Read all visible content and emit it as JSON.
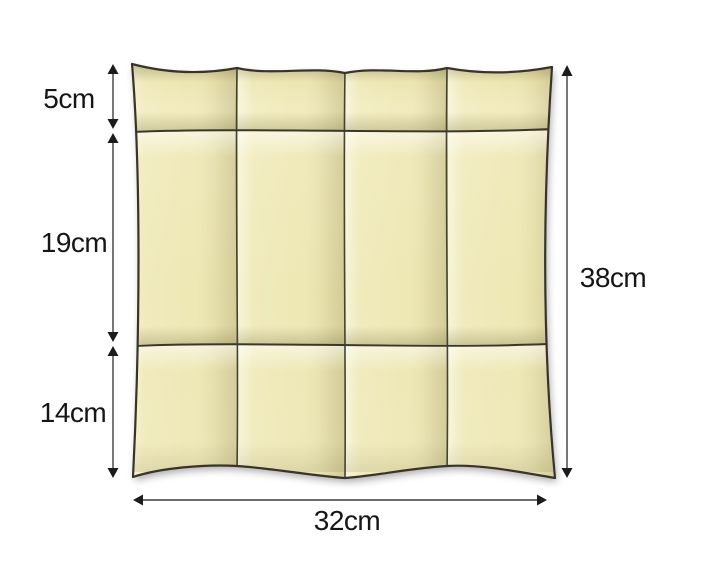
{
  "figure": {
    "subject": "folded-cloth-dimension-diagram",
    "background_color": "#ffffff",
    "cloth": {
      "base_color": "#ece6b0",
      "highlight_color": "#f7f2d0",
      "shadow_color": "#dcd39b",
      "outline_color": "#37342a",
      "grid_columns": 4,
      "grid_rows": 3
    },
    "annotation": {
      "line_color": "#3d3d3d",
      "arrowhead_color": "#1c1c1c",
      "text_color": "#161616"
    },
    "labels": {
      "row_top": "5cm",
      "row_middle": "19cm",
      "row_bottom": "14cm",
      "total_height": "38cm",
      "total_width": "32cm"
    },
    "measurements": {
      "row_heights_cm": [
        5,
        19,
        14
      ],
      "total_height_cm": 38,
      "total_width_cm": 32,
      "columns": 4
    }
  }
}
